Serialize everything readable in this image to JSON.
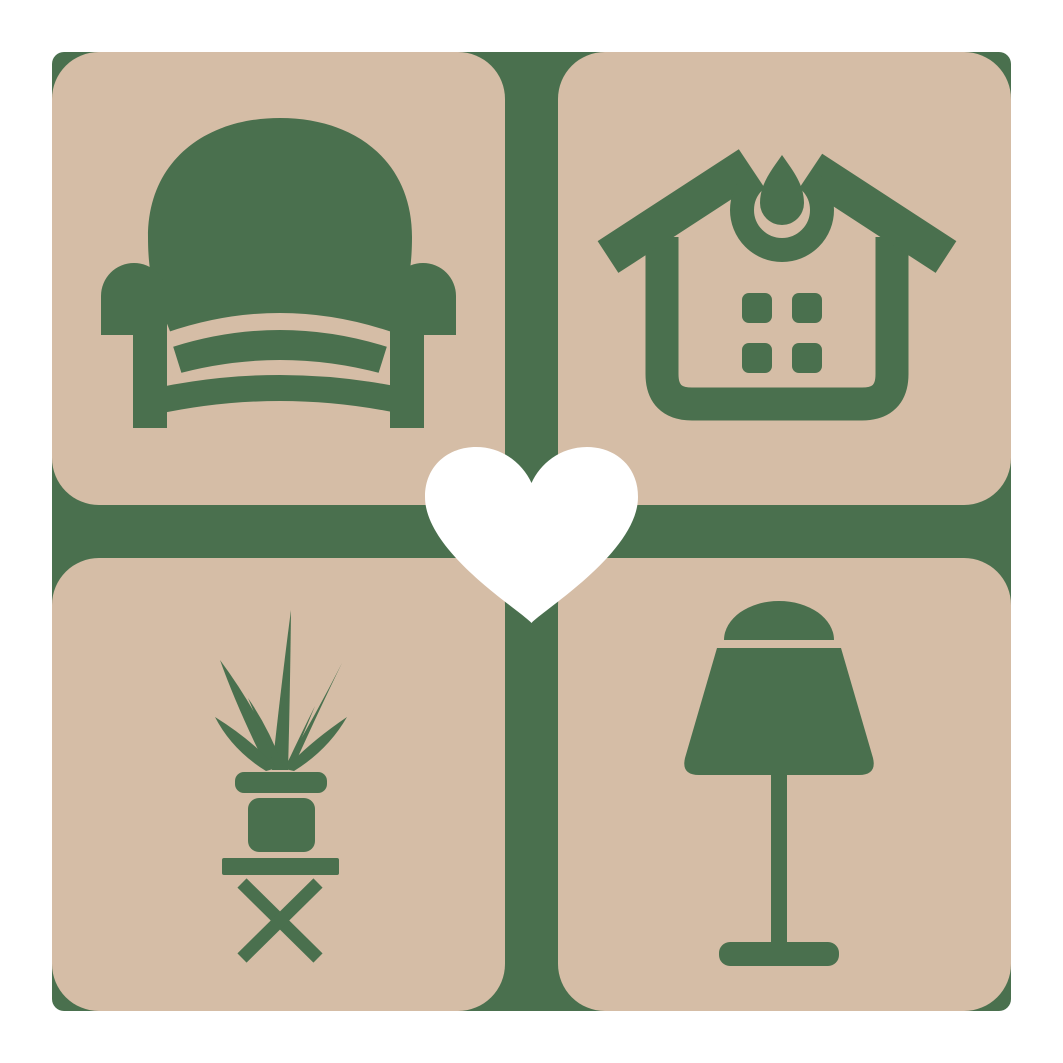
{
  "colors": {
    "page-bg": "#ffffff",
    "tile": "#d5bda6",
    "icon": "#4a704e",
    "heart": "#ffffff"
  },
  "logo": {
    "description": "four rounded tiles with home furnishing icons around a central heart",
    "tiles": [
      {
        "position": "top-left",
        "icon": "armchair-icon"
      },
      {
        "position": "top-right",
        "icon": "house-icon"
      },
      {
        "position": "bottom-left",
        "icon": "potted-plant-icon"
      },
      {
        "position": "bottom-right",
        "icon": "table-lamp-icon"
      }
    ],
    "center_icon": "heart-icon"
  }
}
